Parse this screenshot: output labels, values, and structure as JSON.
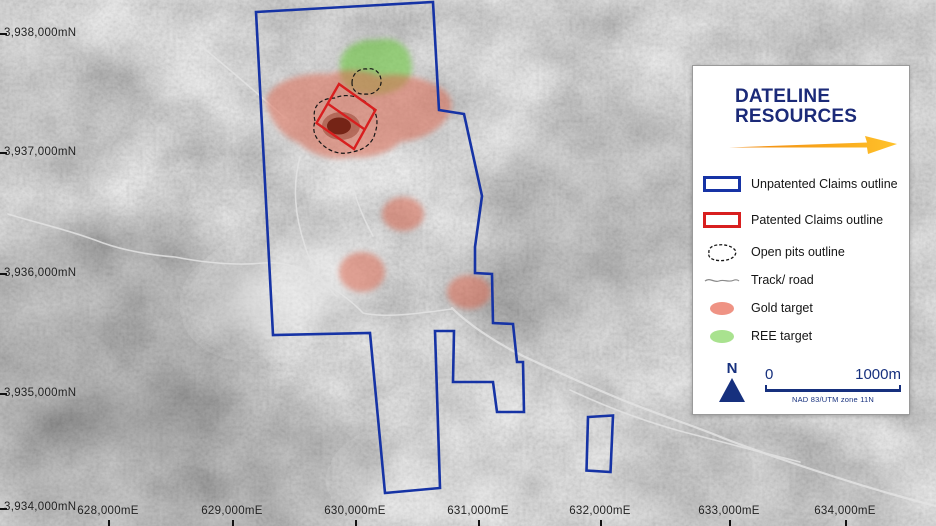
{
  "logo": {
    "line1": "DATELINE",
    "line2": "RESOURCES"
  },
  "legend": {
    "items": [
      {
        "id": "unpatented",
        "label": "Unpatented Claims outline"
      },
      {
        "id": "patented",
        "label": "Patented Claims outline"
      },
      {
        "id": "open-pits",
        "label": "Open pits outline"
      },
      {
        "id": "track",
        "label": "Track/ road"
      },
      {
        "id": "gold",
        "label": "Gold target"
      },
      {
        "id": "ree",
        "label": "REE target"
      }
    ],
    "north_label": "N",
    "scale": {
      "zero": "0",
      "max": "1000m",
      "datum": "NAD 83/UTM zone 11N"
    }
  },
  "axes": {
    "northings": [
      "3,938,000mN",
      "3,937,000mN",
      "3,936,000mN",
      "3,935,000mN",
      "3,934,000mN"
    ],
    "eastings": [
      "628,000mE",
      "629,000mE",
      "630,000mE",
      "631,000mE",
      "632,000mE",
      "633,000mE",
      "634,000mE"
    ]
  },
  "colors": {
    "claims_blue": "#1633a5",
    "patented_red": "#d81f1f",
    "gold_target": "#e8826e",
    "ree_target": "#86d162",
    "logo_navy": "#1b2a78",
    "arrow_orange": "#f6a21a"
  }
}
